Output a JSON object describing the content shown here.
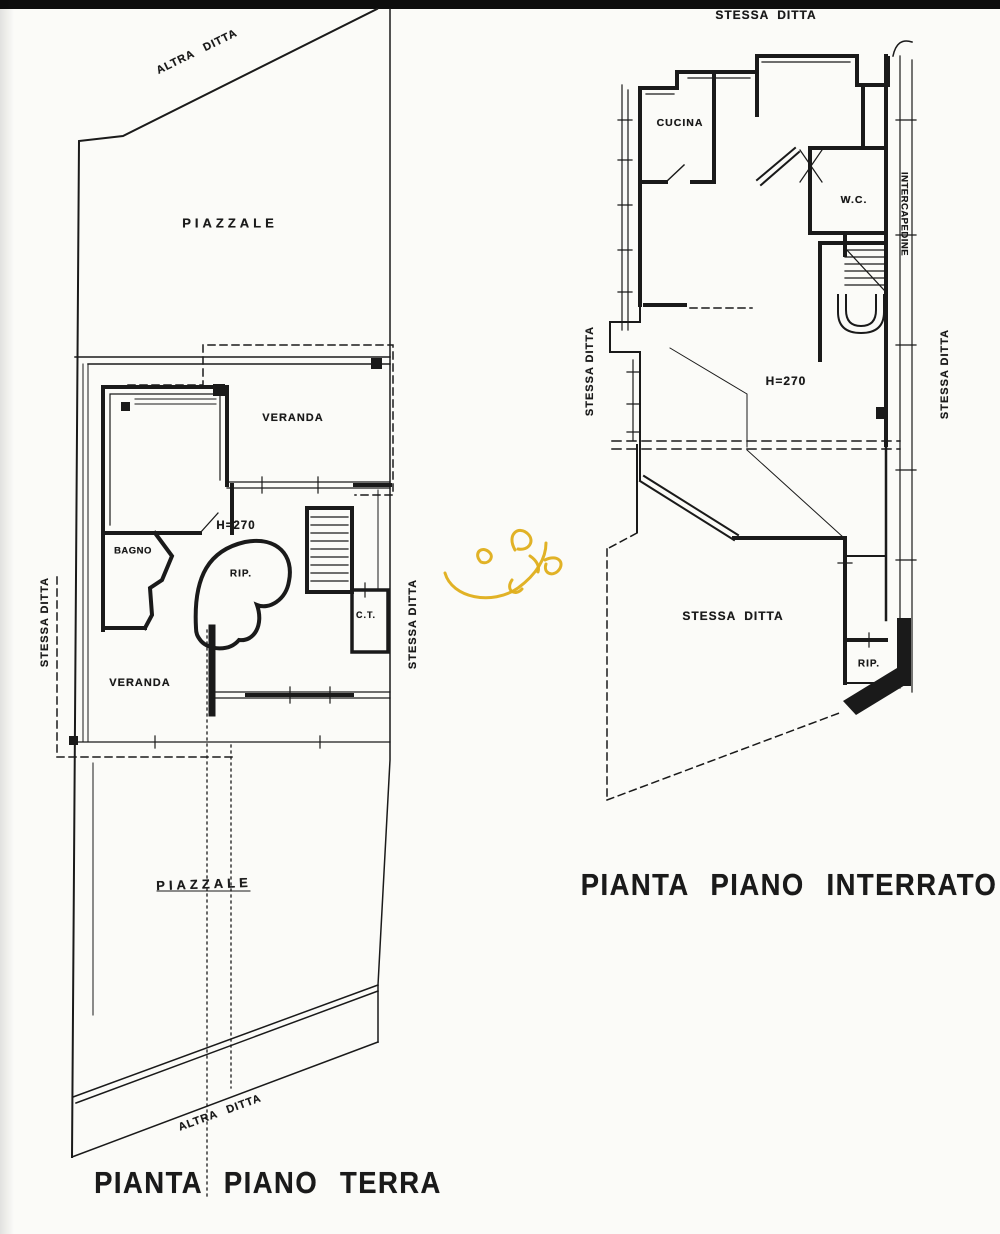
{
  "colors": {
    "ink": "#1a1a1a",
    "paper": "#fbfbf8",
    "top_band": "#0d0d0d",
    "signature": "#dfae1a"
  },
  "plan_terra": {
    "title": "PIANTA PIANO TERRA",
    "labels": {
      "altra_ditta_top": "ALTRA DITTA",
      "piazzale_top": "PIAZZALE",
      "veranda_top": "VERANDA",
      "h270": "H=270",
      "bagno": "BAGNO",
      "rip": "RIP.",
      "ct": "C.T.",
      "stessa_ditta_left": "STESSA DITTA",
      "veranda_lower": "VERANDA",
      "stessa_ditta_right": "STESSA DITTA",
      "piazzale_bottom": "PIAZZALE",
      "altra_ditta_bottom": "ALTRA DITTA"
    }
  },
  "plan_interrato": {
    "title": "PIANTA PIANO INTERRATO",
    "labels": {
      "stessa_ditta_top": "STESSA DITTA",
      "cucina": "CUCINA",
      "wc": "W.C.",
      "intercapedine": "INTERCAPEDINE",
      "stessa_ditta_left": "STESSA DITTA",
      "h270": "H=270",
      "stessa_ditta_right": "STESSA DITTA",
      "stessa_ditta_mid": "STESSA DITTA",
      "rip": "RIP."
    }
  }
}
